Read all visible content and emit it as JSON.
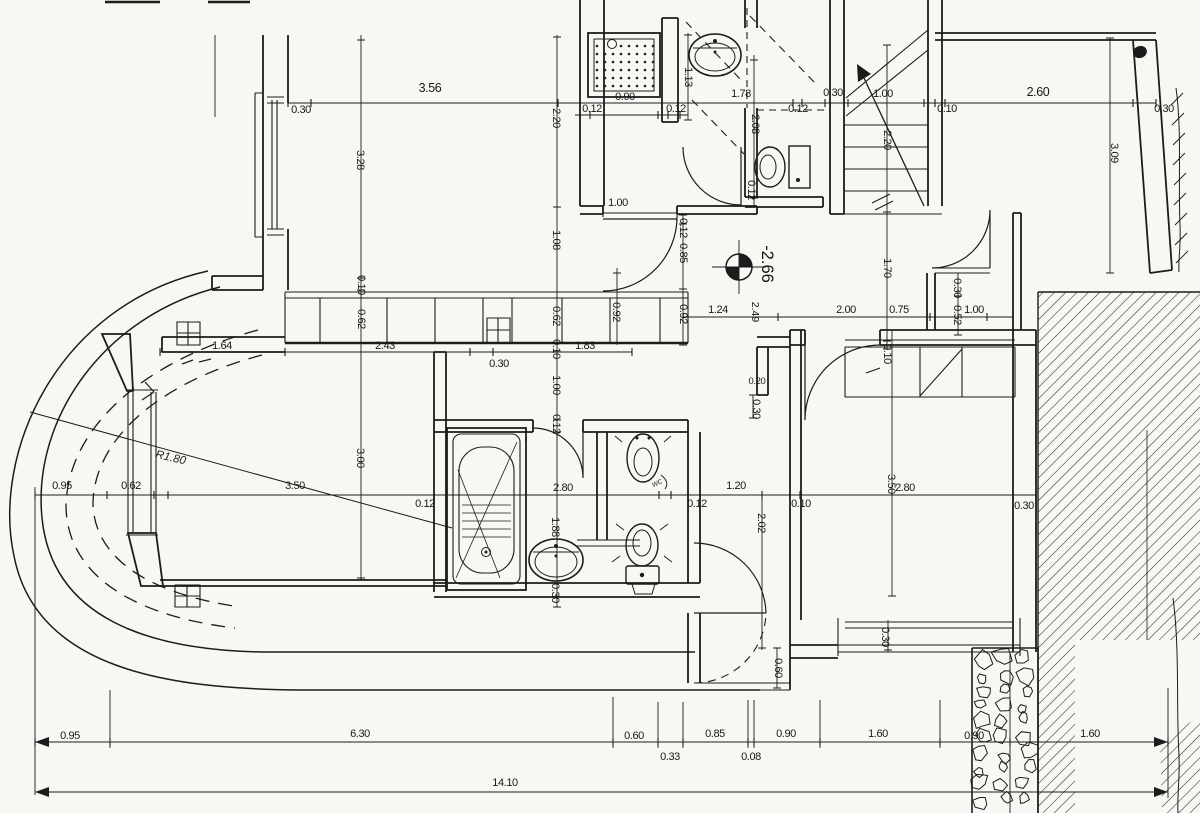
{
  "drawing": {
    "type": "architectural-floor-plan",
    "colors": {
      "paper": "#f8f7f3",
      "ink": "#1c1c1c"
    },
    "level_marker": {
      "elevation": "-2.66",
      "x": 762,
      "y": 264,
      "sub_value": "2.49",
      "sub_x": 752,
      "sub_y": 312
    },
    "radius_label": {
      "text": "R1.80",
      "x": 170,
      "y": 461,
      "rot": 13
    },
    "fixture_label": {
      "text": "wc",
      "x": 658,
      "y": 485,
      "rot": -25
    },
    "total_dim": {
      "text": "14.10",
      "x": 505,
      "y": 786
    }
  },
  "labels": [
    {
      "t": "3.56",
      "x": 430,
      "y": 92,
      "s": 12.5
    },
    {
      "t": "0.30",
      "x": 301,
      "y": 113
    },
    {
      "t": "0.12",
      "x": 592,
      "y": 112
    },
    {
      "t": "0.90",
      "x": 625,
      "y": 100
    },
    {
      "t": "0.12",
      "x": 676,
      "y": 112
    },
    {
      "t": "1.78",
      "x": 741,
      "y": 97
    },
    {
      "t": "0.12",
      "x": 798,
      "y": 112
    },
    {
      "t": "0.30",
      "x": 833,
      "y": 96
    },
    {
      "t": "1.00",
      "x": 883,
      "y": 97
    },
    {
      "t": "0.10",
      "x": 947,
      "y": 112
    },
    {
      "t": "2.60",
      "x": 1038,
      "y": 96,
      "s": 12.5
    },
    {
      "t": "0.30",
      "x": 1164,
      "y": 112
    },
    {
      "t": "3.28",
      "x": 357,
      "y": 160,
      "r": 90
    },
    {
      "t": "2.20",
      "x": 553,
      "y": 118,
      "r": 90
    },
    {
      "t": "1.13",
      "x": 685,
      "y": 77,
      "r": 90
    },
    {
      "t": "2.08",
      "x": 752,
      "y": 124,
      "r": 90
    },
    {
      "t": "0.12",
      "x": 748,
      "y": 190,
      "r": 90
    },
    {
      "t": "2.20",
      "x": 884,
      "y": 140,
      "r": 90
    },
    {
      "t": "3.09",
      "x": 1111,
      "y": 153,
      "r": 90
    },
    {
      "t": "1.70",
      "x": 884,
      "y": 268,
      "r": 90
    },
    {
      "t": "1.08",
      "x": 553,
      "y": 240,
      "r": 90
    },
    {
      "t": "0.62",
      "x": 553,
      "y": 316,
      "r": 90
    },
    {
      "t": "0.10",
      "x": 553,
      "y": 349,
      "r": 90
    },
    {
      "t": "1.00",
      "x": 553,
      "y": 385,
      "r": 90
    },
    {
      "t": "0.12",
      "x": 553,
      "y": 424,
      "r": 90
    },
    {
      "t": "0.10",
      "x": 358,
      "y": 285,
      "r": 90
    },
    {
      "t": "0.62",
      "x": 358,
      "y": 319,
      "r": 90
    },
    {
      "t": "3.00",
      "x": 357,
      "y": 458,
      "r": 90
    },
    {
      "t": "0.92",
      "x": 613,
      "y": 312,
      "r": 90
    },
    {
      "t": "0.12",
      "x": 680,
      "y": 228,
      "r": 90
    },
    {
      "t": "0.85",
      "x": 680,
      "y": 253,
      "r": 90
    },
    {
      "t": "0.92",
      "x": 680,
      "y": 314,
      "r": 90
    },
    {
      "t": "1.64",
      "x": 222,
      "y": 349
    },
    {
      "t": "2.43",
      "x": 385,
      "y": 349
    },
    {
      "t": "0.30",
      "x": 499,
      "y": 367
    },
    {
      "t": "1.83",
      "x": 585,
      "y": 349
    },
    {
      "t": "1.00",
      "x": 618,
      "y": 206
    },
    {
      "t": "1.24",
      "x": 718,
      "y": 313
    },
    {
      "t": "2.00",
      "x": 846,
      "y": 313
    },
    {
      "t": "0.75",
      "x": 899,
      "y": 313
    },
    {
      "t": "1.00",
      "x": 974,
      "y": 313
    },
    {
      "t": "0.30",
      "x": 954,
      "y": 288,
      "r": 90
    },
    {
      "t": "0.52",
      "x": 954,
      "y": 315,
      "r": 90
    },
    {
      "t": "0.10",
      "x": 884,
      "y": 354,
      "r": 90
    },
    {
      "t": "0.20",
      "x": 757,
      "y": 384,
      "s": 9.5
    },
    {
      "t": "0.30",
      "x": 753,
      "y": 409,
      "r": 90
    },
    {
      "t": "0.95",
      "x": 62,
      "y": 489
    },
    {
      "t": "0.62",
      "x": 131,
      "y": 489
    },
    {
      "t": "3.50",
      "x": 295,
      "y": 489
    },
    {
      "t": "0.12",
      "x": 425,
      "y": 507
    },
    {
      "t": "2.80",
      "x": 563,
      "y": 491
    },
    {
      "t": "0.12",
      "x": 697,
      "y": 507
    },
    {
      "t": "1.20",
      "x": 736,
      "y": 489
    },
    {
      "t": "0.10",
      "x": 801,
      "y": 507
    },
    {
      "t": "2.80",
      "x": 905,
      "y": 491
    },
    {
      "t": "0.30",
      "x": 1024,
      "y": 509
    },
    {
      "t": "1.88",
      "x": 552,
      "y": 527,
      "r": 90
    },
    {
      "t": "0.30",
      "x": 552,
      "y": 593,
      "r": 90
    },
    {
      "t": "2.02",
      "x": 758,
      "y": 523,
      "r": 90
    },
    {
      "t": "3.50",
      "x": 888,
      "y": 484,
      "r": 90
    },
    {
      "t": "0.60",
      "x": 775,
      "y": 668,
      "r": 90
    },
    {
      "t": "0.30",
      "x": 882,
      "y": 637,
      "r": 90
    },
    {
      "t": "0.95",
      "x": 70,
      "y": 739
    },
    {
      "t": "6.30",
      "x": 360,
      "y": 737
    },
    {
      "t": "0.60",
      "x": 634,
      "y": 739
    },
    {
      "t": "0.33",
      "x": 670,
      "y": 760
    },
    {
      "t": "0.85",
      "x": 715,
      "y": 737
    },
    {
      "t": "0.08",
      "x": 751,
      "y": 760
    },
    {
      "t": "0.90",
      "x": 786,
      "y": 737
    },
    {
      "t": "1.60",
      "x": 878,
      "y": 737
    },
    {
      "t": "0.90",
      "x": 974,
      "y": 739
    },
    {
      "t": "1.60",
      "x": 1090,
      "y": 737
    }
  ]
}
